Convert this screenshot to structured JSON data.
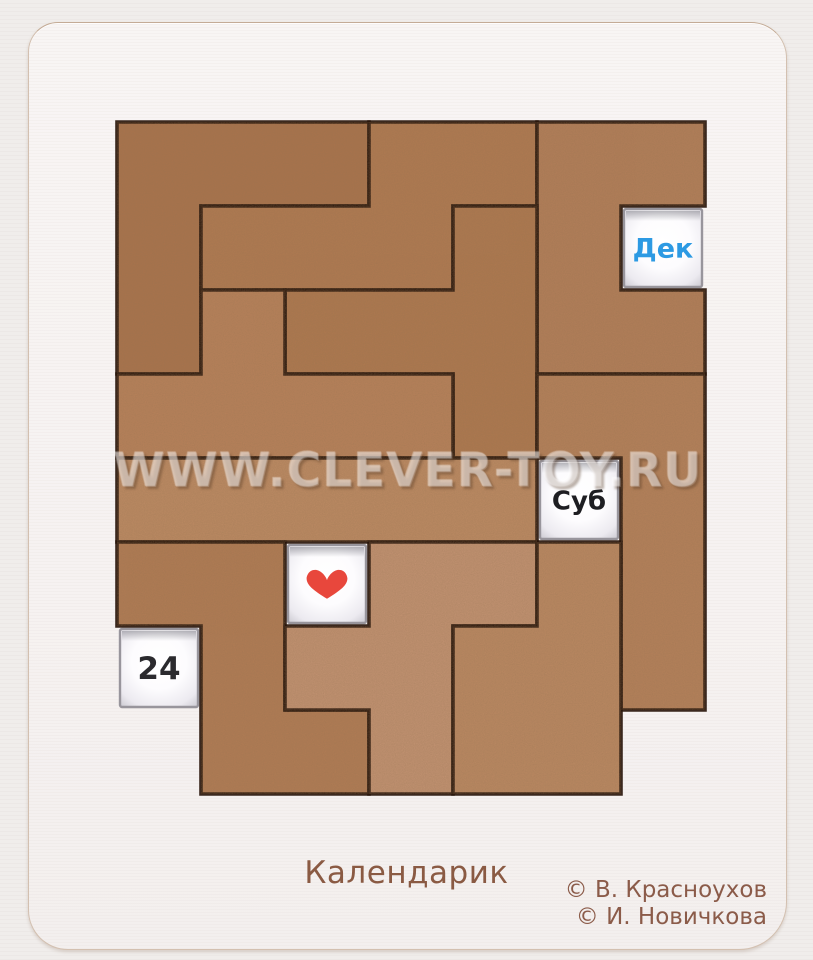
{
  "watermark": "WWW.CLEVER-TOY.RU",
  "title": "Календарик",
  "credits": [
    "© В. Красноухов",
    "© И. Новичкова"
  ],
  "colors": {
    "background": "#f0edeb",
    "board": "#f7f4f3",
    "piece_edge": "#2a170c",
    "window_frame": "#98959c",
    "month_text": "#2d9ae3",
    "weekday_text": "#1e1e22",
    "date_text": "#2b2a2e",
    "heart": "#e8473c",
    "caption_brown": "#8a5a43"
  },
  "puzzle": {
    "grid": {
      "origin_x": 117,
      "origin_y": 122,
      "cell": 84,
      "cols": 7,
      "rows": 8
    },
    "windows": [
      {
        "id": "month",
        "label": "Дек",
        "type": "text",
        "col": 6,
        "row": 1,
        "color": "#2d9ae3",
        "font": 27
      },
      {
        "id": "weekday",
        "label": "Суб",
        "type": "text",
        "col": 5,
        "row": 4,
        "color": "#1e1e22",
        "font": 26
      },
      {
        "id": "heart",
        "label": "♥",
        "type": "heart",
        "col": 2,
        "row": 5,
        "color": "#e8473c",
        "font": 30
      },
      {
        "id": "date",
        "label": "24",
        "type": "text",
        "col": 0,
        "row": 6,
        "color": "#2b2a2e",
        "font": 31
      }
    ],
    "pieces": [
      {
        "name": "V-pentomino",
        "fill": "#a9724c",
        "cells": [
          [
            0,
            0
          ],
          [
            1,
            0
          ],
          [
            2,
            0
          ],
          [
            0,
            1
          ],
          [
            0,
            2
          ]
        ]
      },
      {
        "name": "N-pentomino-top",
        "fill": "#b07951",
        "cells": [
          [
            3,
            0
          ],
          [
            4,
            0
          ],
          [
            1,
            1
          ],
          [
            2,
            1
          ],
          [
            3,
            1
          ]
        ]
      },
      {
        "name": "U-pentomino",
        "fill": "#b37e59",
        "cells": [
          [
            5,
            0
          ],
          [
            6,
            0
          ],
          [
            5,
            1
          ],
          [
            5,
            2
          ],
          [
            6,
            2
          ]
        ]
      },
      {
        "name": "T-pentomino",
        "fill": "#ae784f",
        "cells": [
          [
            4,
            1
          ],
          [
            2,
            2
          ],
          [
            3,
            2
          ],
          [
            4,
            2
          ],
          [
            4,
            3
          ]
        ]
      },
      {
        "name": "Y-pentomino",
        "fill": "#b8815a",
        "cells": [
          [
            1,
            2
          ],
          [
            0,
            3
          ],
          [
            1,
            3
          ],
          [
            2,
            3
          ],
          [
            3,
            3
          ]
        ]
      },
      {
        "name": "I-pentomino",
        "fill": "#bd8a63",
        "cells": [
          [
            0,
            4
          ],
          [
            1,
            4
          ],
          [
            2,
            4
          ],
          [
            3,
            4
          ],
          [
            4,
            4
          ]
        ]
      },
      {
        "name": "L-pentomino",
        "fill": "#b5805a",
        "cells": [
          [
            5,
            3
          ],
          [
            6,
            3
          ],
          [
            6,
            4
          ],
          [
            6,
            5
          ],
          [
            6,
            6
          ]
        ]
      },
      {
        "name": "N-pentomino-bottom",
        "fill": "#b17b54",
        "cells": [
          [
            0,
            5
          ],
          [
            1,
            5
          ],
          [
            1,
            6
          ],
          [
            1,
            7
          ],
          [
            2,
            7
          ]
        ]
      },
      {
        "name": "F-pentomino",
        "fill": "#c39272",
        "cells": [
          [
            3,
            5
          ],
          [
            4,
            5
          ],
          [
            2,
            6
          ],
          [
            3,
            6
          ],
          [
            3,
            7
          ]
        ]
      },
      {
        "name": "P-pentomino",
        "fill": "#bb8862",
        "cells": [
          [
            5,
            5
          ],
          [
            4,
            6
          ],
          [
            5,
            6
          ],
          [
            4,
            7
          ],
          [
            5,
            7
          ]
        ]
      }
    ]
  }
}
